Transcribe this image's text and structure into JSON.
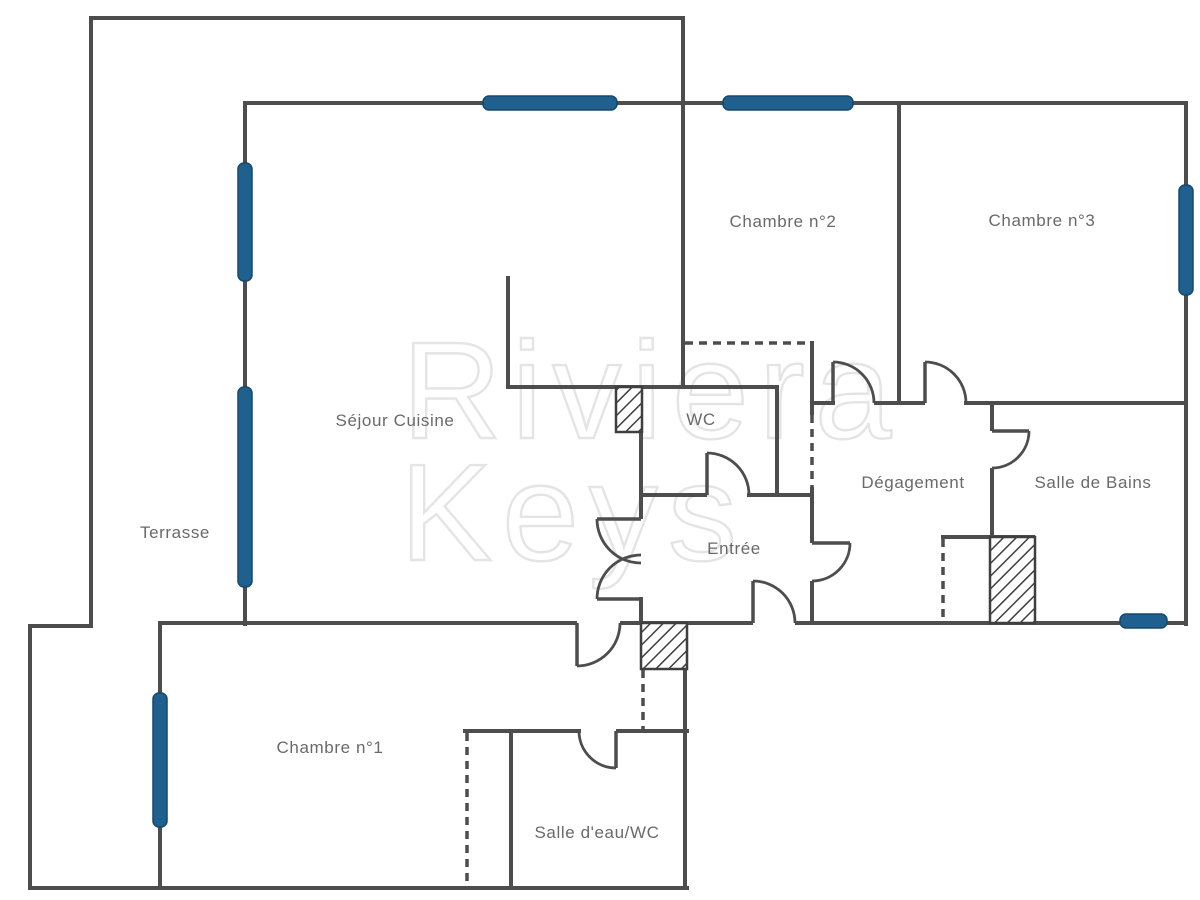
{
  "page": {
    "background": "#ffffff",
    "width": 1200,
    "height": 900
  },
  "style": {
    "wall_color": "#4d4d4d",
    "wall_thickness": 4,
    "window_color": "#1f608f",
    "window_edge_color": "#15496e",
    "label_color": "#6a6a6a",
    "hatch_color": "#3f3f3f",
    "dash_pattern": "8,6"
  },
  "watermark": {
    "line1": "Riviera",
    "line2": "Keys",
    "color": "#e4e4e4",
    "font_size": 138,
    "line1_x": 402,
    "line1_y": 438,
    "line2_x": 400,
    "line2_y": 560
  },
  "rooms": [
    {
      "id": "terrasse",
      "label": "Terrasse",
      "x": 175,
      "y": 538
    },
    {
      "id": "sejour-cuisine",
      "label": "Séjour Cuisine",
      "x": 395,
      "y": 426
    },
    {
      "id": "chambre-1",
      "label": "Chambre n°1",
      "x": 330,
      "y": 753
    },
    {
      "id": "chambre-2",
      "label": "Chambre n°2",
      "x": 783,
      "y": 227
    },
    {
      "id": "chambre-3",
      "label": "Chambre n°3",
      "x": 1042,
      "y": 226
    },
    {
      "id": "wc",
      "label": "WC",
      "x": 701,
      "y": 425
    },
    {
      "id": "entree",
      "label": "Entrée",
      "x": 734,
      "y": 554
    },
    {
      "id": "degagement",
      "label": "Dégagement",
      "x": 913,
      "y": 488
    },
    {
      "id": "salle-de-bains",
      "label": "Salle de Bains",
      "x": 1093,
      "y": 488
    },
    {
      "id": "salle-deau-wc",
      "label": "Salle d'eau/WC",
      "x": 597,
      "y": 838
    }
  ],
  "walls": [
    [
      89,
      16,
      596,
      4
    ],
    [
      89,
      16,
      4,
      612
    ],
    [
      28,
      624,
      65,
      4
    ],
    [
      28,
      624,
      4,
      266
    ],
    [
      28,
      886,
      661,
      4
    ],
    [
      681,
      16,
      4,
      373
    ],
    [
      243,
      101,
      945,
      4
    ],
    [
      1184,
      101,
      4,
      525
    ],
    [
      243,
      101,
      4,
      525
    ],
    [
      158,
      621,
      4,
      269
    ],
    [
      158,
      621,
      419,
      4
    ],
    [
      620,
      621,
      133,
      4
    ],
    [
      795,
      621,
      391,
      4
    ],
    [
      506,
      276,
      4,
      111
    ],
    [
      506,
      385,
      272,
      4
    ],
    [
      639,
      385,
      4,
      134
    ],
    [
      639,
      597,
      4,
      28
    ],
    [
      639,
      493,
      68,
      4
    ],
    [
      747,
      493,
      67,
      4
    ],
    [
      775,
      385,
      4,
      112
    ],
    [
      810,
      341,
      4,
      74
    ],
    [
      810,
      487,
      4,
      56
    ],
    [
      810,
      581,
      4,
      44
    ],
    [
      810,
      401,
      25,
      4
    ],
    [
      874,
      401,
      51,
      4
    ],
    [
      964,
      401,
      224,
      4
    ],
    [
      897,
      101,
      4,
      304
    ],
    [
      990,
      401,
      4,
      30
    ],
    [
      990,
      468,
      4,
      71
    ],
    [
      941,
      535,
      94,
      4
    ],
    [
      463,
      729,
      118,
      4
    ],
    [
      616,
      729,
      73,
      4
    ],
    [
      509,
      731,
      4,
      159
    ],
    [
      683,
      621,
      4,
      269
    ]
  ],
  "dashed_lines": [
    [
      685,
      343,
      812,
      343
    ],
    [
      812,
      415,
      812,
      487
    ],
    [
      943,
      539,
      943,
      622
    ],
    [
      643,
      670,
      643,
      729
    ],
    [
      467,
      733,
      467,
      884
    ]
  ],
  "windows": [
    [
      483,
      96,
      134,
      14
    ],
    [
      723,
      96,
      130,
      14
    ],
    [
      1179,
      185,
      14,
      110
    ],
    [
      238,
      163,
      14,
      118
    ],
    [
      238,
      387,
      14,
      200
    ],
    [
      153,
      693,
      14,
      134
    ],
    [
      1120,
      614,
      47,
      14
    ]
  ],
  "doors": [
    {
      "id": "door-chambre-2",
      "leaf": [
        833,
        403,
        833,
        362
      ],
      "arc": "M833,362 A41,41 0 0 1 874,403"
    },
    {
      "id": "door-chambre-3",
      "leaf": [
        925,
        403,
        925,
        362
      ],
      "arc": "M925,362 A41,41 0 0 1 966,403"
    },
    {
      "id": "door-salle-bains",
      "leaf": [
        992,
        431,
        1029,
        431
      ],
      "arc": "M1029,431 A37,37 0 0 1 992,468"
    },
    {
      "id": "door-degagement",
      "leaf": [
        812,
        543,
        850,
        543
      ],
      "arc": "M850,543 A38,38 0 0 1 812,581"
    },
    {
      "id": "door-entree-sud",
      "leaf": [
        753,
        623,
        753,
        581
      ],
      "arc": "M753,581 A42,42 0 0 1 795,623"
    },
    {
      "id": "door-wc",
      "leaf": [
        707,
        495,
        707,
        453
      ],
      "arc": "M707,453 A42,42 0 0 1 749,495"
    },
    {
      "id": "door-sejour-haut",
      "leaf": [
        597,
        519,
        641,
        519
      ],
      "arc": "M597,519 A44,44 0 0 0 641,563"
    },
    {
      "id": "door-sejour-bas",
      "leaf": [
        597,
        599,
        641,
        599
      ],
      "arc": "M597,599 A44,44 0 0 1 641,555"
    },
    {
      "id": "door-chambre-1",
      "leaf": [
        577,
        623,
        577,
        666
      ],
      "arc": "M577,666 A43,43 0 0 0 620,623"
    },
    {
      "id": "door-salle-deau",
      "leaf": [
        616,
        731,
        616,
        768
      ],
      "arc": "M616,768 A37,37 0 0 1 579,731"
    }
  ],
  "hatches": [
    [
      616,
      387,
      26,
      45
    ],
    [
      641,
      623,
      46,
      46
    ],
    [
      990,
      537,
      45,
      86
    ]
  ]
}
